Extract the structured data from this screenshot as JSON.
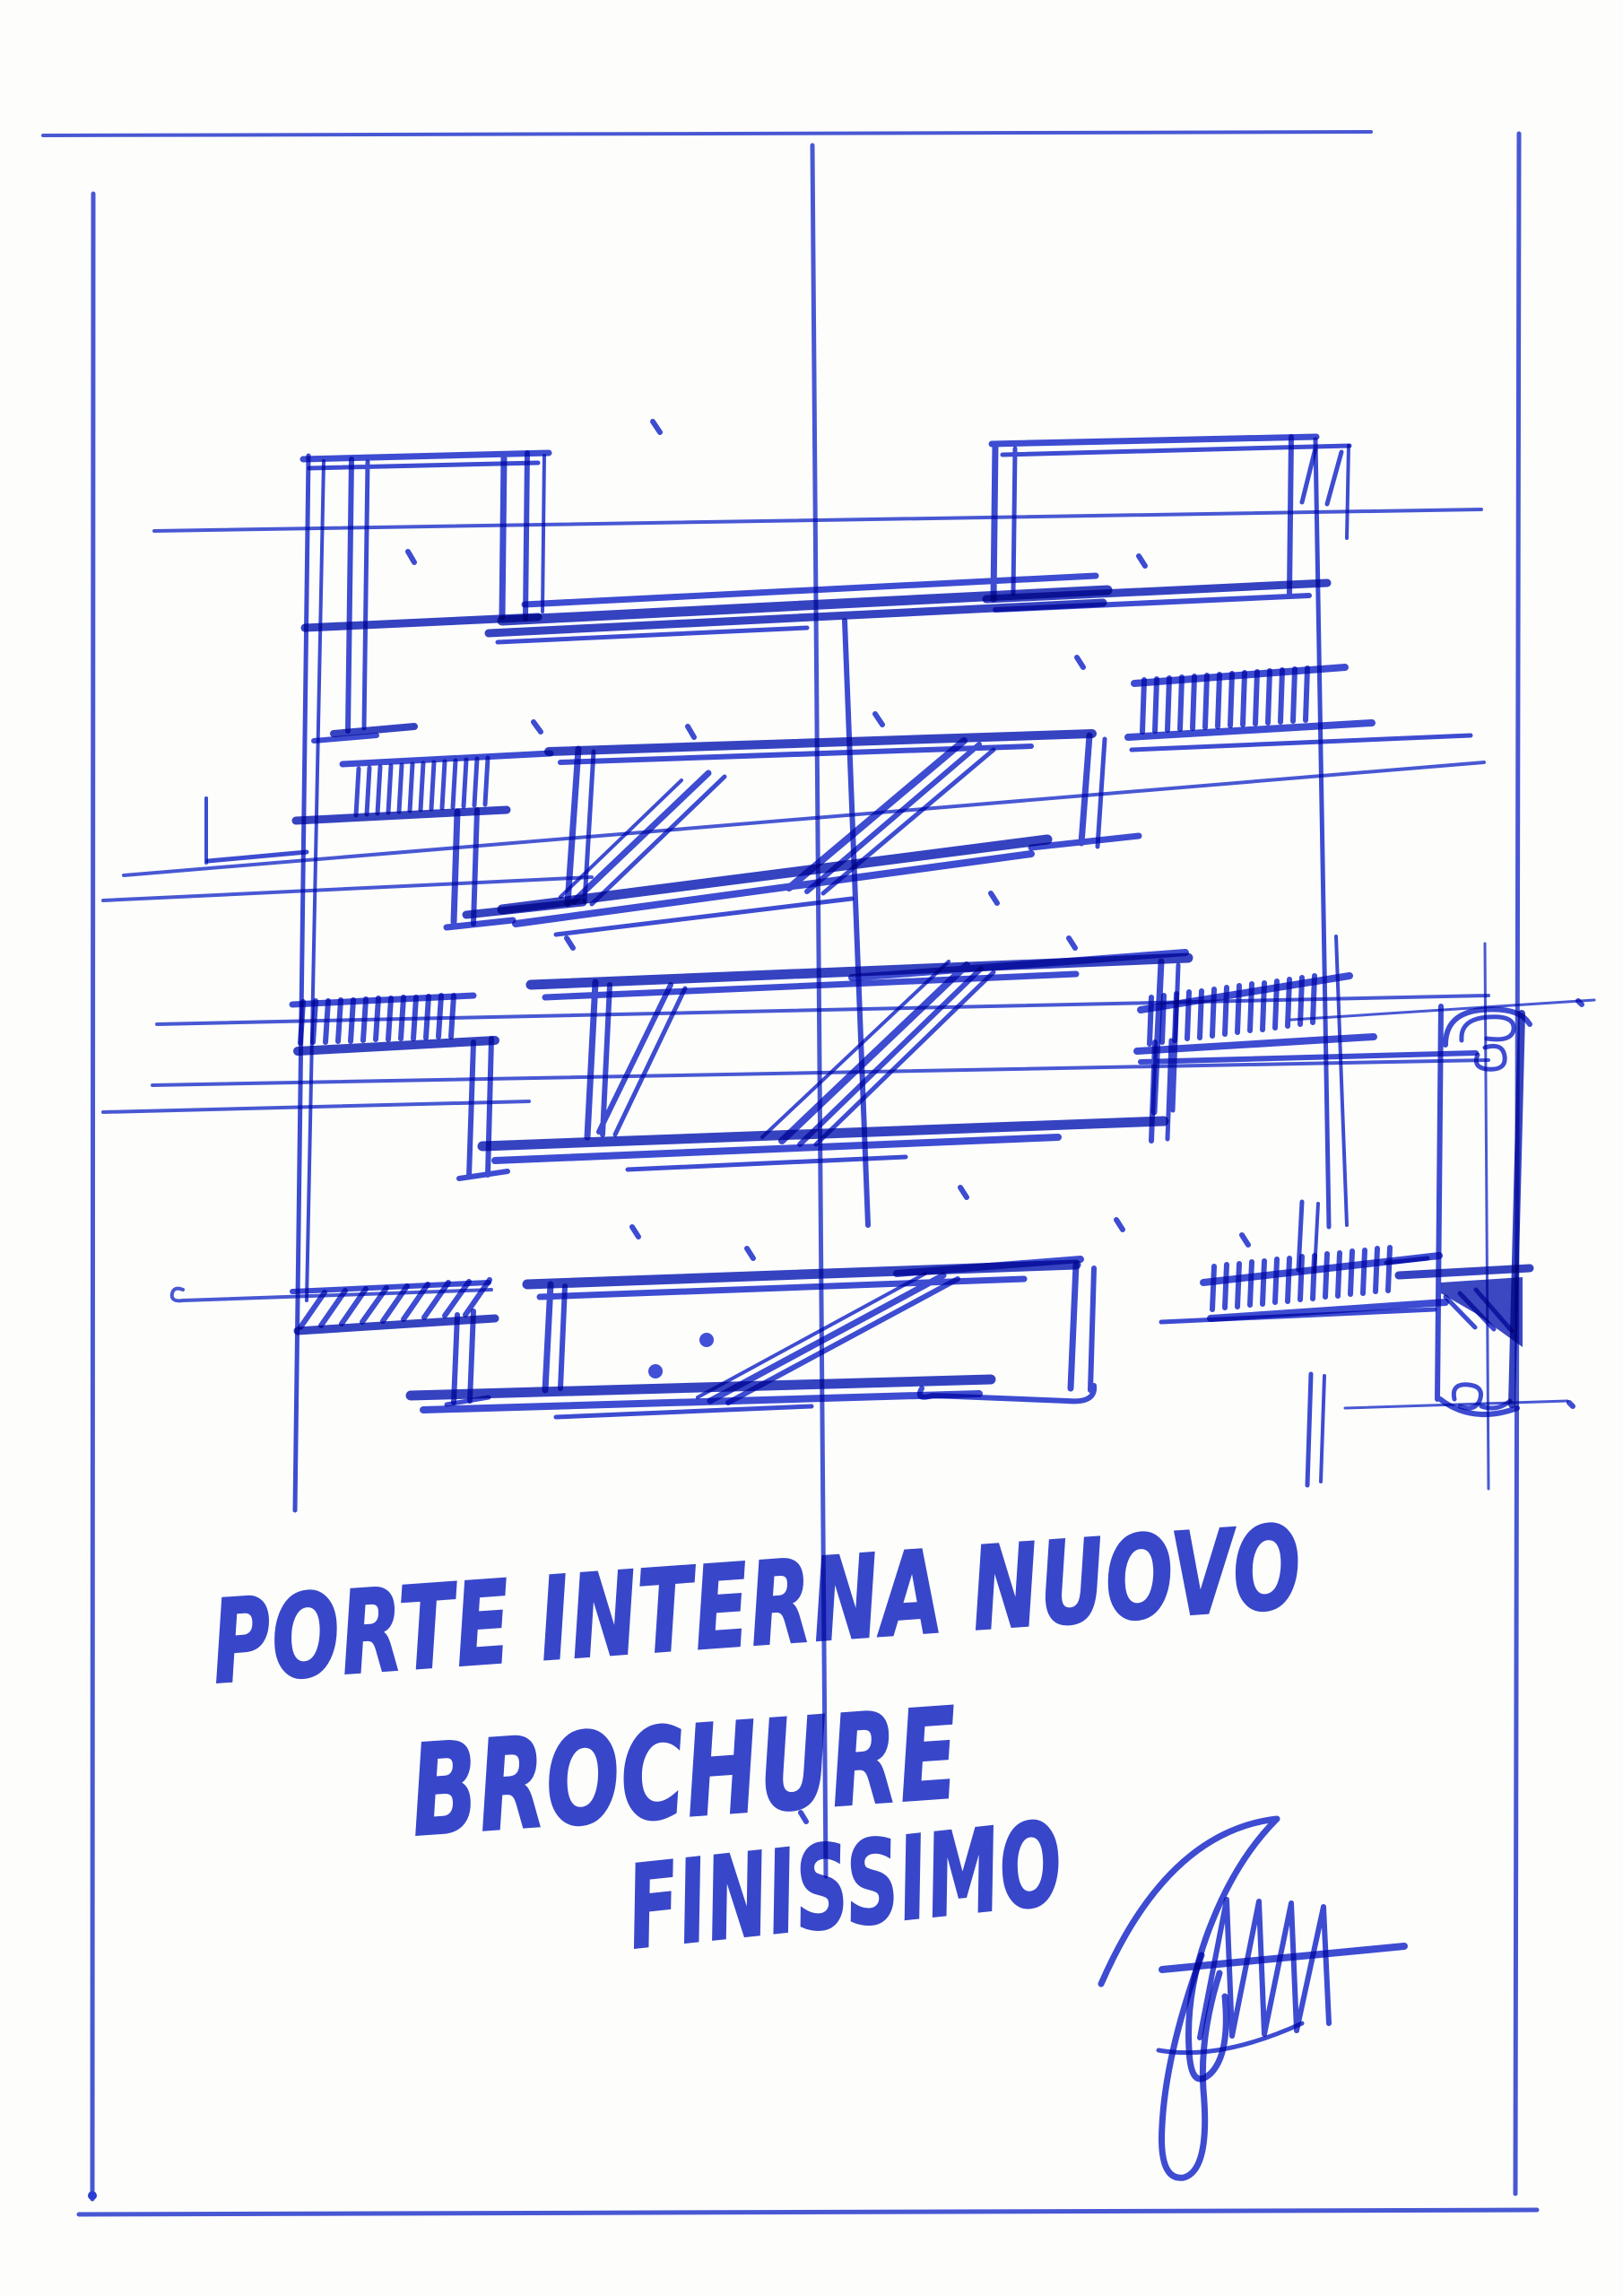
{
  "sketch": {
    "caption_line1": "PORTE INTERNA NUOVO",
    "caption_line2": "BROCHURE",
    "caption_line3": "FINISSIMO",
    "icons": {
      "signature": "signature-scribble-icon",
      "scroll_detail_top": "spiral-scroll-icon",
      "scroll_detail_bottom": "spiral-scroll-icon"
    },
    "colors": {
      "ink": "#2c3dd1",
      "ink_dark": "#1f2ebd",
      "ink_light": "#5b6bdc",
      "paper": "#fdfdfc"
    }
  }
}
